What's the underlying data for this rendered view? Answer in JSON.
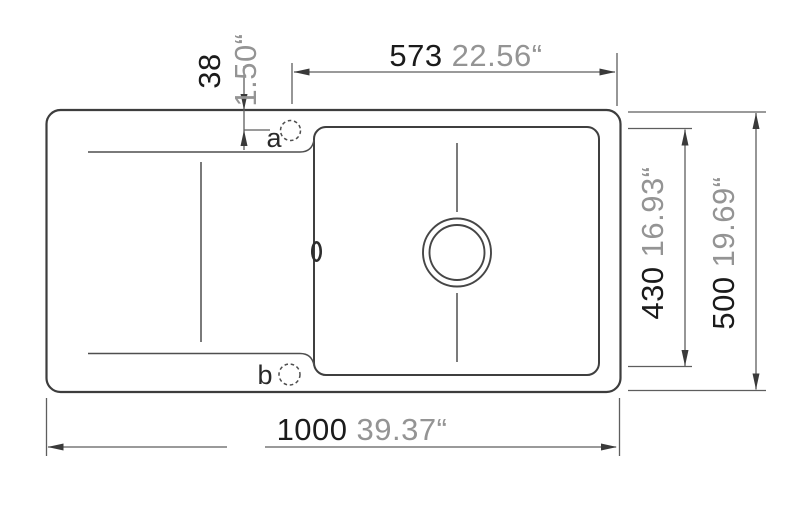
{
  "drawing": {
    "kind": "sink top-view installation drawing",
    "holes": {
      "a": "a",
      "b": "b"
    },
    "dimensions": {
      "basin_width": {
        "mm": "573",
        "inch": "22.56“"
      },
      "tap_offset": {
        "mm": "38",
        "inch": "1.50“"
      },
      "basin_depth": {
        "mm": "430",
        "inch": "16.93“"
      },
      "overall_depth": {
        "mm": "500",
        "inch": "19.69“"
      },
      "overall_width": {
        "mm": "1000",
        "inch": "39.37“"
      }
    },
    "colors": {
      "background": "#ffffff",
      "outline": "#3d3d3d",
      "dimension_lines": "#5e5e5e",
      "mm_text": "#1b1b1b",
      "inch_text": "#949494"
    }
  }
}
